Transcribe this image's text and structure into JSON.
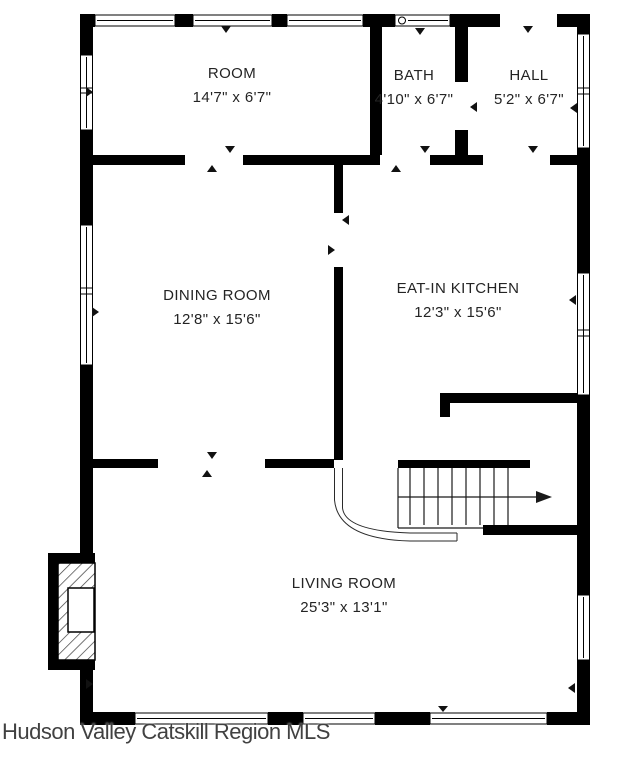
{
  "plan": {
    "footer": "Hudson Valley Catskill Region MLS",
    "colors": {
      "wall": "#000000",
      "background": "#ffffff",
      "label_text": "#242424",
      "footer_text": "#414141"
    },
    "rooms": [
      {
        "name": "ROOM",
        "dims": "14'7\" x 6'7\""
      },
      {
        "name": "BATH",
        "dims": "4'10\" x 6'7\""
      },
      {
        "name": "HALL",
        "dims": "5'2\" x 6'7\""
      },
      {
        "name": "DINING ROOM",
        "dims": "12'8\" x 15'6\""
      },
      {
        "name": "EAT-IN KITCHEN",
        "dims": "12'3\" x 15'6\""
      },
      {
        "name": "LIVING ROOM",
        "dims": "25'3\" x 13'1\""
      }
    ]
  }
}
